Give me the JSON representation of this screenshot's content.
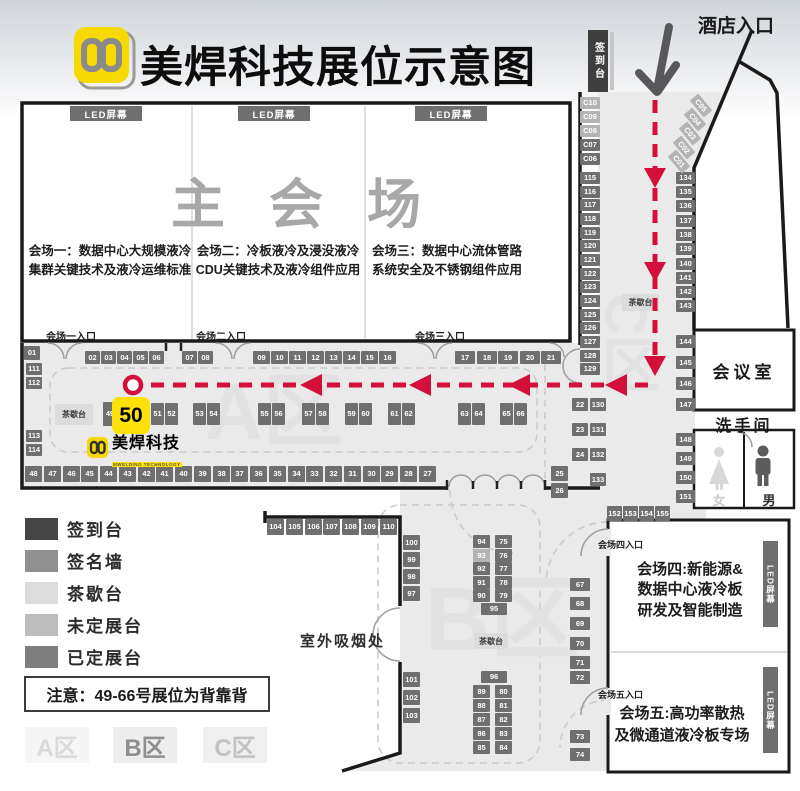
{
  "header": {
    "title": "美焊科技展位示意图",
    "hotel_entrance": "酒店入口",
    "signin_desk": "签到台"
  },
  "main_hall": {
    "name": "主会场",
    "led_label": "LED屏幕",
    "sessions": [
      {
        "line1": "会场一：数据中心大规模液冷",
        "line2": "集群关键技术及液冷运维标准",
        "entrance": "会场一入口"
      },
      {
        "line1": "会场二：冷板液冷及浸没液冷",
        "line2": "CDU关键技术及液冷组件应用",
        "entrance": "会场二入口"
      },
      {
        "line1": "会场三：数据中心流体管路",
        "line2": "系统安全及不锈钢组件应用",
        "entrance": "会场三入口"
      }
    ]
  },
  "halls": {
    "hall4": {
      "entrance": "会场四入口",
      "led": "LED屏幕",
      "lines": [
        "会场四:新能源&",
        "数据中心液冷板",
        "研发及智能制造"
      ]
    },
    "hall5": {
      "entrance": "会场五入口",
      "led": "LED屏幕",
      "lines": [
        "会场五:高功率散热",
        "及微通道液冷板专场"
      ]
    }
  },
  "rooms": {
    "meeting": "会议室",
    "restroom": "洗手间",
    "female": "女",
    "male": "男",
    "smoking": "室外吸烟处",
    "tea_label": "茶歇台"
  },
  "watermarks": {
    "a": "A区",
    "b": "B区",
    "c": "C区"
  },
  "map_logo": {
    "name": "美焊科技",
    "sub": "MWELDING TECHNOLOGY"
  },
  "legend": {
    "items": [
      {
        "label": "签到台",
        "color": "#454545"
      },
      {
        "label": "签名墙",
        "color": "#8f8f8f"
      },
      {
        "label": "茶歇台",
        "color": "#dcdcdc"
      },
      {
        "label": "未定展台",
        "color": "#bdbdbd"
      },
      {
        "label": "已定展台",
        "color": "#7e7e7e"
      }
    ],
    "note": "注意：49-66号展位为背靠背",
    "zones": [
      {
        "label": "A区",
        "bg": "#f5f5f5",
        "fg": "#dadada"
      },
      {
        "label": "B区",
        "bg": "#ededed",
        "fg": "#8f8f8f"
      },
      {
        "label": "C区",
        "bg": "#efefef",
        "fg": "#c2c2c2"
      }
    ]
  },
  "colors": {
    "accent_red": "#d50f3c",
    "highlight_yellow": "#ffe10a",
    "brand_yellow": "#f6d900",
    "booth_booked": "#6f6f6f",
    "booth_pending": "#b4b4b4",
    "floor": "#eaeaea",
    "wall": "#1a1a1a"
  },
  "map": {
    "highlight": {
      "label": "50",
      "x": 112,
      "y": 397,
      "w": 38,
      "h": 37
    },
    "tea_stations": [
      {
        "label": "茶歇台",
        "x": 55,
        "y": 404,
        "w": 38,
        "h": 21
      },
      {
        "label": "茶歇台",
        "x": 622,
        "y": 294,
        "w": 37,
        "h": 17
      },
      {
        "label": "茶歇台",
        "x": 474,
        "y": 633,
        "w": 34,
        "h": 16
      }
    ],
    "booths": [
      [
        "01",
        24,
        346,
        16,
        14,
        "d"
      ],
      [
        "02",
        85,
        351,
        15,
        13,
        "d"
      ],
      [
        "03",
        101,
        351,
        15,
        13,
        "d"
      ],
      [
        "04",
        117,
        351,
        15,
        13,
        "d"
      ],
      [
        "05",
        133,
        351,
        15,
        13,
        "d"
      ],
      [
        "06",
        149,
        351,
        15,
        13,
        "d"
      ],
      [
        "07",
        182,
        351,
        15,
        13,
        "d"
      ],
      [
        "08",
        198,
        351,
        15,
        13,
        "d"
      ],
      [
        "09",
        253,
        351,
        17,
        13,
        "d"
      ],
      [
        "10",
        271,
        351,
        17,
        13,
        "d"
      ],
      [
        "11",
        289,
        351,
        17,
        13,
        "d"
      ],
      [
        "12",
        307,
        351,
        17,
        13,
        "d"
      ],
      [
        "13",
        325,
        351,
        17,
        13,
        "d"
      ],
      [
        "14",
        343,
        351,
        17,
        13,
        "d"
      ],
      [
        "15",
        361,
        351,
        17,
        13,
        "d"
      ],
      [
        "16",
        379,
        351,
        17,
        13,
        "d"
      ],
      [
        "17",
        455,
        351,
        20,
        13,
        "d"
      ],
      [
        "18",
        477,
        351,
        20,
        13,
        "d"
      ],
      [
        "19",
        498,
        351,
        20,
        13,
        "d"
      ],
      [
        "20",
        520,
        351,
        20,
        13,
        "d"
      ],
      [
        "21",
        541,
        351,
        20,
        13,
        "d"
      ],
      [
        "111",
        26,
        363,
        16,
        12,
        "d"
      ],
      [
        "112",
        26,
        377,
        16,
        12,
        "d"
      ],
      [
        "113",
        26,
        430,
        16,
        12,
        "d"
      ],
      [
        "114",
        26,
        444,
        16,
        12,
        "d"
      ],
      [
        "49",
        103,
        402,
        14,
        24,
        "d"
      ],
      [
        "51",
        151,
        403,
        13,
        22,
        "d"
      ],
      [
        "52",
        165,
        403,
        13,
        22,
        "d"
      ],
      [
        "53",
        193,
        403,
        13,
        22,
        "d"
      ],
      [
        "54",
        207,
        403,
        13,
        22,
        "d"
      ],
      [
        "55",
        258,
        403,
        13,
        22,
        "d"
      ],
      [
        "56",
        272,
        403,
        13,
        22,
        "d"
      ],
      [
        "57",
        302,
        403,
        13,
        22,
        "d"
      ],
      [
        "58",
        316,
        403,
        13,
        22,
        "d"
      ],
      [
        "59",
        345,
        403,
        13,
        22,
        "d"
      ],
      [
        "60",
        359,
        403,
        13,
        22,
        "d"
      ],
      [
        "61",
        388,
        403,
        13,
        22,
        "d"
      ],
      [
        "62",
        402,
        403,
        13,
        22,
        "d"
      ],
      [
        "63",
        458,
        403,
        13,
        22,
        "d"
      ],
      [
        "64",
        472,
        403,
        13,
        22,
        "d"
      ],
      [
        "65",
        500,
        403,
        13,
        22,
        "d"
      ],
      [
        "66",
        514,
        403,
        13,
        22,
        "d"
      ],
      [
        "48",
        25,
        466,
        17,
        16,
        "d"
      ],
      [
        "47",
        44,
        466,
        17,
        16,
        "d"
      ],
      [
        "46",
        63,
        466,
        17,
        16,
        "d"
      ],
      [
        "45",
        81,
        466,
        17,
        16,
        "d"
      ],
      [
        "44",
        100,
        466,
        17,
        16,
        "d"
      ],
      [
        "43",
        119,
        466,
        17,
        16,
        "d"
      ],
      [
        "42",
        138,
        466,
        17,
        16,
        "d"
      ],
      [
        "41",
        156,
        466,
        17,
        16,
        "d"
      ],
      [
        "40",
        175,
        466,
        17,
        16,
        "d"
      ],
      [
        "39",
        194,
        466,
        17,
        16,
        "d"
      ],
      [
        "38",
        213,
        466,
        17,
        16,
        "d"
      ],
      [
        "37",
        231,
        466,
        17,
        16,
        "d"
      ],
      [
        "36",
        250,
        466,
        17,
        16,
        "d"
      ],
      [
        "35",
        269,
        466,
        17,
        16,
        "d"
      ],
      [
        "34",
        288,
        466,
        17,
        16,
        "d"
      ],
      [
        "33",
        306,
        466,
        17,
        16,
        "d"
      ],
      [
        "32",
        325,
        466,
        17,
        16,
        "d"
      ],
      [
        "31",
        344,
        466,
        17,
        16,
        "d"
      ],
      [
        "30",
        363,
        466,
        17,
        16,
        "d"
      ],
      [
        "29",
        381,
        466,
        17,
        16,
        "d"
      ],
      [
        "28",
        400,
        466,
        17,
        16,
        "d"
      ],
      [
        "27",
        419,
        466,
        17,
        16,
        "d"
      ],
      [
        "25",
        551,
        466,
        17,
        15,
        "d"
      ],
      [
        "26",
        551,
        483,
        17,
        15,
        "d"
      ],
      [
        "22",
        572,
        398,
        16,
        13,
        "d"
      ],
      [
        "23",
        572,
        423,
        16,
        13,
        "d"
      ],
      [
        "24",
        572,
        448,
        16,
        13,
        "d"
      ],
      [
        "130",
        590,
        398,
        16,
        13,
        "d"
      ],
      [
        "131",
        590,
        423,
        16,
        13,
        "d"
      ],
      [
        "132",
        590,
        448,
        16,
        13,
        "d"
      ],
      [
        "133",
        590,
        473,
        16,
        13,
        "d"
      ],
      [
        "C10",
        580,
        97,
        20,
        12,
        "u"
      ],
      [
        "C09",
        580,
        111,
        20,
        12,
        "u"
      ],
      [
        "C08",
        580,
        125,
        20,
        12,
        "u"
      ],
      [
        "C07",
        580,
        139,
        20,
        12,
        "d"
      ],
      [
        "C06",
        580,
        153,
        20,
        12,
        "d"
      ],
      [
        "115",
        580,
        172,
        20,
        12,
        "d"
      ],
      [
        "116",
        580,
        186,
        20,
        12,
        "d"
      ],
      [
        "117",
        580,
        199,
        20,
        12,
        "d"
      ],
      [
        "118",
        580,
        213,
        20,
        12,
        "d"
      ],
      [
        "119",
        580,
        227,
        20,
        12,
        "d"
      ],
      [
        "120",
        580,
        240,
        20,
        12,
        "d"
      ],
      [
        "121",
        580,
        254,
        20,
        12,
        "d"
      ],
      [
        "122",
        580,
        268,
        20,
        12,
        "d"
      ],
      [
        "123",
        580,
        281,
        20,
        12,
        "d"
      ],
      [
        "124",
        580,
        295,
        20,
        12,
        "d"
      ],
      [
        "125",
        580,
        309,
        20,
        12,
        "d"
      ],
      [
        "126",
        580,
        322,
        20,
        12,
        "d"
      ],
      [
        "127",
        580,
        336,
        20,
        12,
        "d"
      ],
      [
        "128",
        580,
        350,
        20,
        12,
        "d"
      ],
      [
        "129",
        580,
        363,
        20,
        12,
        "d"
      ],
      [
        "134",
        676,
        172,
        19,
        12,
        "d"
      ],
      [
        "135",
        676,
        186,
        19,
        12,
        "d"
      ],
      [
        "136",
        676,
        200,
        19,
        12,
        "d"
      ],
      [
        "137",
        676,
        215,
        19,
        12,
        "d"
      ],
      [
        "138",
        676,
        229,
        19,
        12,
        "d"
      ],
      [
        "139",
        676,
        243,
        19,
        12,
        "d"
      ],
      [
        "140",
        676,
        258,
        19,
        12,
        "d"
      ],
      [
        "141",
        676,
        272,
        19,
        12,
        "d"
      ],
      [
        "142",
        676,
        286,
        19,
        12,
        "d"
      ],
      [
        "143",
        676,
        300,
        19,
        12,
        "d"
      ],
      [
        "144",
        676,
        335,
        19,
        13,
        "d"
      ],
      [
        "145",
        676,
        356,
        19,
        13,
        "d"
      ],
      [
        "146",
        676,
        377,
        19,
        13,
        "d"
      ],
      [
        "147",
        676,
        398,
        19,
        13,
        "d"
      ],
      [
        "148",
        676,
        433,
        19,
        13,
        "d"
      ],
      [
        "149",
        676,
        452,
        19,
        13,
        "d"
      ],
      [
        "150",
        676,
        471,
        19,
        13,
        "d"
      ],
      [
        "151",
        676,
        490,
        19,
        13,
        "d"
      ],
      [
        "152",
        607,
        506,
        15,
        15,
        "d"
      ],
      [
        "153",
        623,
        506,
        15,
        15,
        "d"
      ],
      [
        "154",
        639,
        506,
        15,
        15,
        "d"
      ],
      [
        "155",
        655,
        506,
        15,
        15,
        "d"
      ],
      [
        "C05",
        690,
        100,
        22,
        11,
        "u",
        50
      ],
      [
        "C04",
        684,
        114,
        22,
        11,
        "u",
        50
      ],
      [
        "C03",
        679,
        128,
        22,
        11,
        "u",
        50
      ],
      [
        "C02",
        673,
        142,
        22,
        11,
        "u",
        50
      ],
      [
        "C01",
        668,
        156,
        22,
        11,
        "u",
        50
      ],
      [
        "104",
        267,
        519,
        17,
        16,
        "d"
      ],
      [
        "105",
        286,
        519,
        17,
        16,
        "d"
      ],
      [
        "106",
        305,
        519,
        17,
        16,
        "d"
      ],
      [
        "107",
        323,
        519,
        17,
        16,
        "d"
      ],
      [
        "108",
        342,
        519,
        17,
        16,
        "d"
      ],
      [
        "109",
        361,
        519,
        17,
        16,
        "d"
      ],
      [
        "110",
        380,
        519,
        17,
        16,
        "d"
      ],
      [
        "100",
        403,
        535,
        17,
        15,
        "d"
      ],
      [
        "99",
        403,
        552,
        17,
        15,
        "d"
      ],
      [
        "98",
        403,
        569,
        17,
        15,
        "d"
      ],
      [
        "97",
        403,
        586,
        17,
        15,
        "d"
      ],
      [
        "101",
        403,
        672,
        17,
        15,
        "d"
      ],
      [
        "102",
        403,
        690,
        17,
        15,
        "d"
      ],
      [
        "103",
        403,
        708,
        17,
        15,
        "d"
      ],
      [
        "94",
        473,
        535,
        17,
        13,
        "d"
      ],
      [
        "75",
        495,
        535,
        17,
        13,
        "d"
      ],
      [
        "93",
        473,
        549,
        17,
        13,
        "u"
      ],
      [
        "76",
        495,
        549,
        17,
        13,
        "d"
      ],
      [
        "92",
        473,
        562,
        17,
        13,
        "d"
      ],
      [
        "77",
        495,
        562,
        17,
        13,
        "d"
      ],
      [
        "91",
        473,
        576,
        17,
        13,
        "d"
      ],
      [
        "78",
        495,
        576,
        17,
        13,
        "d"
      ],
      [
        "90",
        473,
        589,
        17,
        13,
        "d"
      ],
      [
        "79",
        495,
        589,
        17,
        13,
        "d"
      ],
      [
        "95",
        481,
        603,
        26,
        12,
        "d"
      ],
      [
        "96",
        481,
        671,
        26,
        12,
        "d"
      ],
      [
        "89",
        473,
        685,
        17,
        13,
        "d"
      ],
      [
        "80",
        495,
        685,
        17,
        13,
        "d"
      ],
      [
        "88",
        473,
        699,
        17,
        13,
        "d"
      ],
      [
        "81",
        495,
        699,
        17,
        13,
        "d"
      ],
      [
        "87",
        473,
        713,
        17,
        13,
        "d"
      ],
      [
        "82",
        495,
        713,
        17,
        13,
        "d"
      ],
      [
        "86",
        473,
        727,
        17,
        13,
        "d"
      ],
      [
        "83",
        495,
        727,
        17,
        13,
        "d"
      ],
      [
        "85",
        473,
        741,
        17,
        13,
        "d"
      ],
      [
        "84",
        495,
        741,
        17,
        13,
        "d"
      ],
      [
        "67",
        570,
        578,
        20,
        13,
        "d"
      ],
      [
        "68",
        570,
        597,
        20,
        13,
        "d"
      ],
      [
        "69",
        570,
        617,
        20,
        13,
        "d"
      ],
      [
        "70",
        570,
        637,
        20,
        13,
        "d"
      ],
      [
        "71",
        570,
        656,
        20,
        13,
        "d"
      ],
      [
        "72",
        570,
        671,
        20,
        13,
        "d"
      ],
      [
        "73",
        570,
        730,
        20,
        13,
        "d"
      ],
      [
        "74",
        570,
        748,
        20,
        13,
        "d"
      ]
    ]
  }
}
